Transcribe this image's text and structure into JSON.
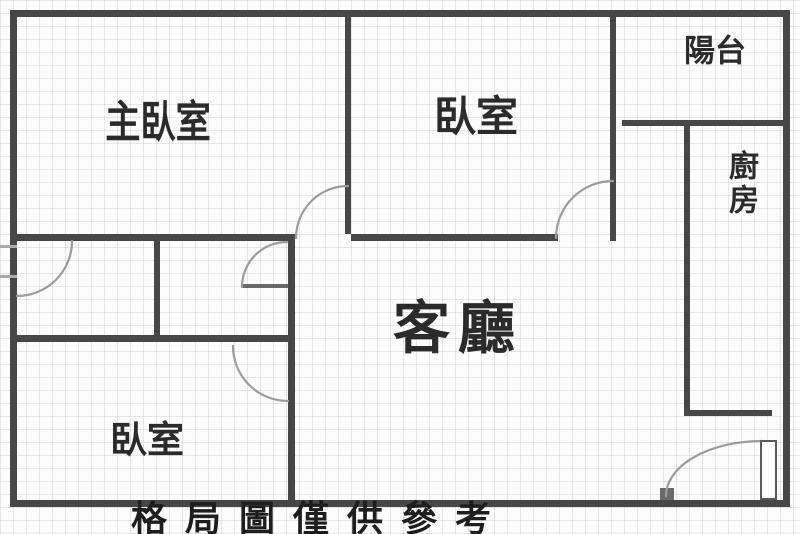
{
  "floor_plan": {
    "rooms": {
      "master_bedroom": {
        "label": "主臥室"
      },
      "bedroom_top": {
        "label": "臥室"
      },
      "balcony": {
        "label": "陽台"
      },
      "kitchen": {
        "label": "廚房"
      },
      "living_room": {
        "label": "客廳"
      },
      "bedroom_bottom": {
        "label": "臥室"
      }
    },
    "caption": "格局圖僅供參考",
    "colors": {
      "wall": "#474747",
      "door_arc": "#9c9c9c",
      "label_text": "#2b2b2b",
      "grid": "#a5a5a5",
      "background": "#fcfcfc"
    }
  }
}
